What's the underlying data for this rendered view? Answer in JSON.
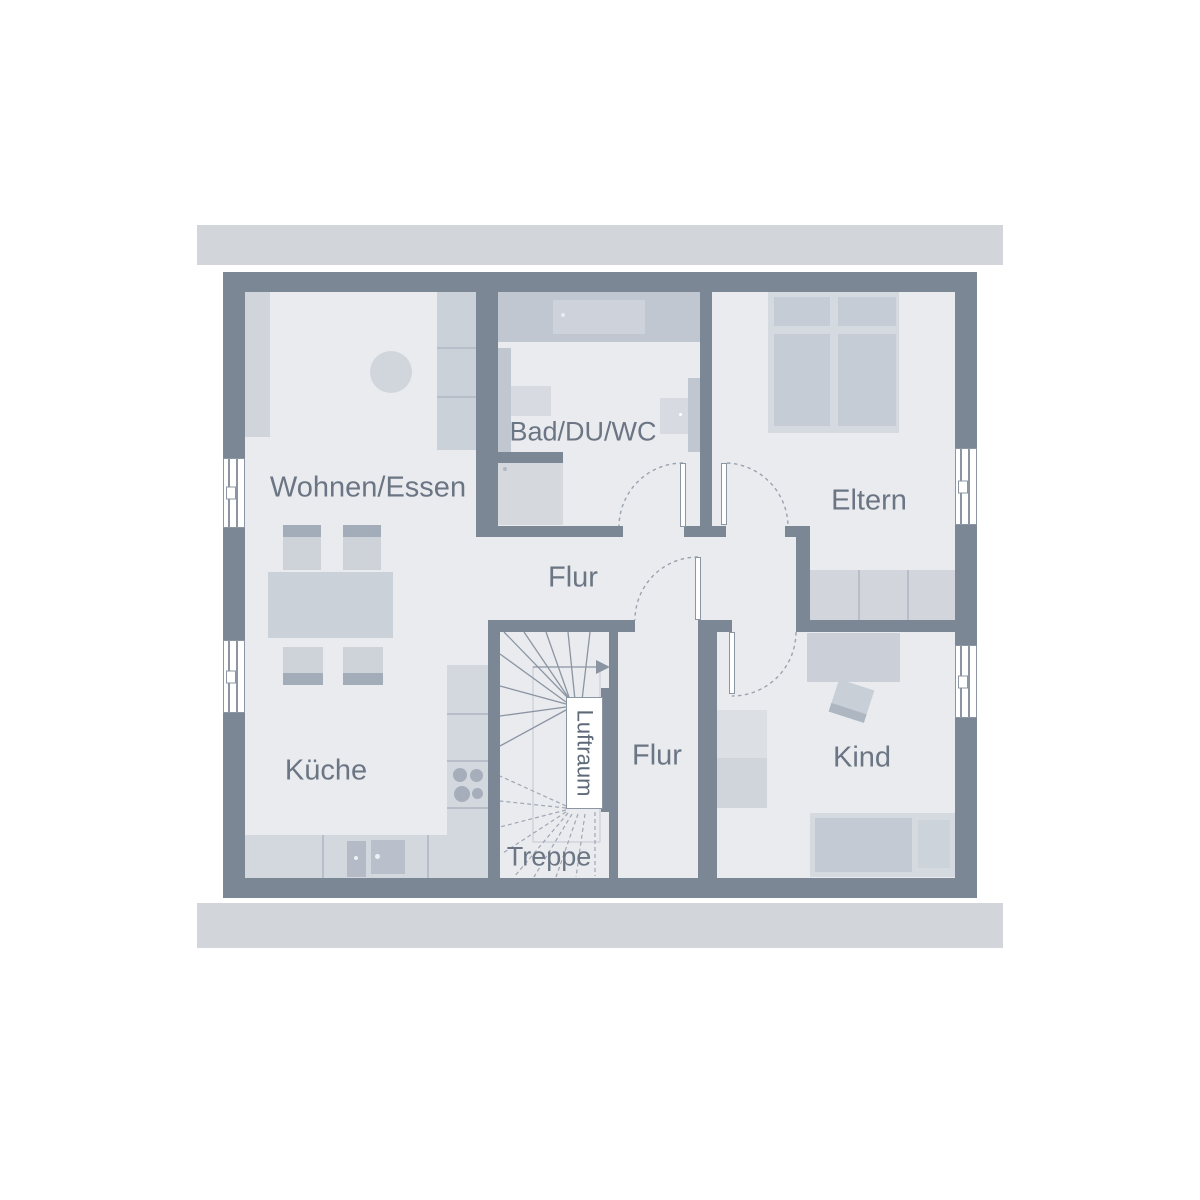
{
  "plan": {
    "type": "floor-plan",
    "floor_labels": {
      "wohnen_essen": "Wohnen/Essen",
      "bad": "Bad/DU/WC",
      "eltern": "Eltern",
      "flur_oben": "Flur",
      "kueche": "Küche",
      "flur_unten": "Flur",
      "kind": "Kind",
      "treppe": "Treppe",
      "luftraum": "Luftraum"
    }
  },
  "colors": {
    "wall": "#7c8795",
    "floor": "#e9ebef",
    "roof": "#d2d5da",
    "text": "#6b7583",
    "line": "#8c96a3",
    "arc": "#9aa3af",
    "furnlight": "#d3d7de",
    "furnmed": "#c5ccd5",
    "furndark": "#a6aebb",
    "platform": "#c0c7d1",
    "appliance": "#b4bbc6"
  }
}
